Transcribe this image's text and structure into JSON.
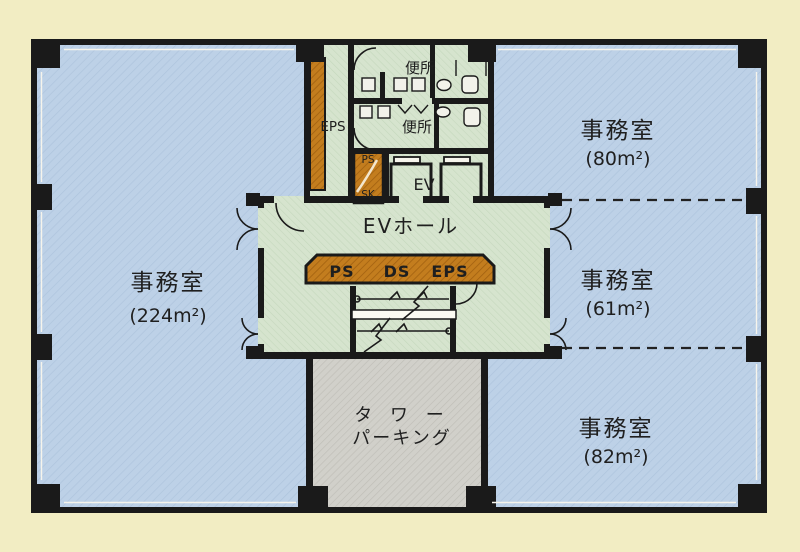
{
  "colors": {
    "background": "#f2edc3",
    "office_fill": "#bdd1e7",
    "core_fill": "#d6e4ce",
    "parking_fill": "#d1d0ca",
    "shaft_fill": "#c37d1e",
    "wall": "#1a1a1a"
  },
  "rooms": {
    "office_left": {
      "label": "事務室",
      "area": "(224m²)"
    },
    "office_top_right": {
      "label": "事務室",
      "area": "(80m²)"
    },
    "office_mid_right": {
      "label": "事務室",
      "area": "(61m²)"
    },
    "office_bottom_right": {
      "label": "事務室",
      "area": "(82m²)"
    },
    "ev_hall": {
      "label": "EVホール"
    },
    "toilet_upper": {
      "label": "便所"
    },
    "toilet_lower": {
      "label": "便所"
    },
    "eps_shaft": {
      "label": "EPS"
    },
    "pipe_space": {
      "top": "PS",
      "bottom": "SK"
    },
    "elevator": {
      "label": "EV"
    },
    "service_bar": {
      "ps": "PS",
      "ds": "DS",
      "eps": "EPS"
    },
    "tower_parking": {
      "line1": "タ ワ ー",
      "line2": "パーキング"
    }
  }
}
